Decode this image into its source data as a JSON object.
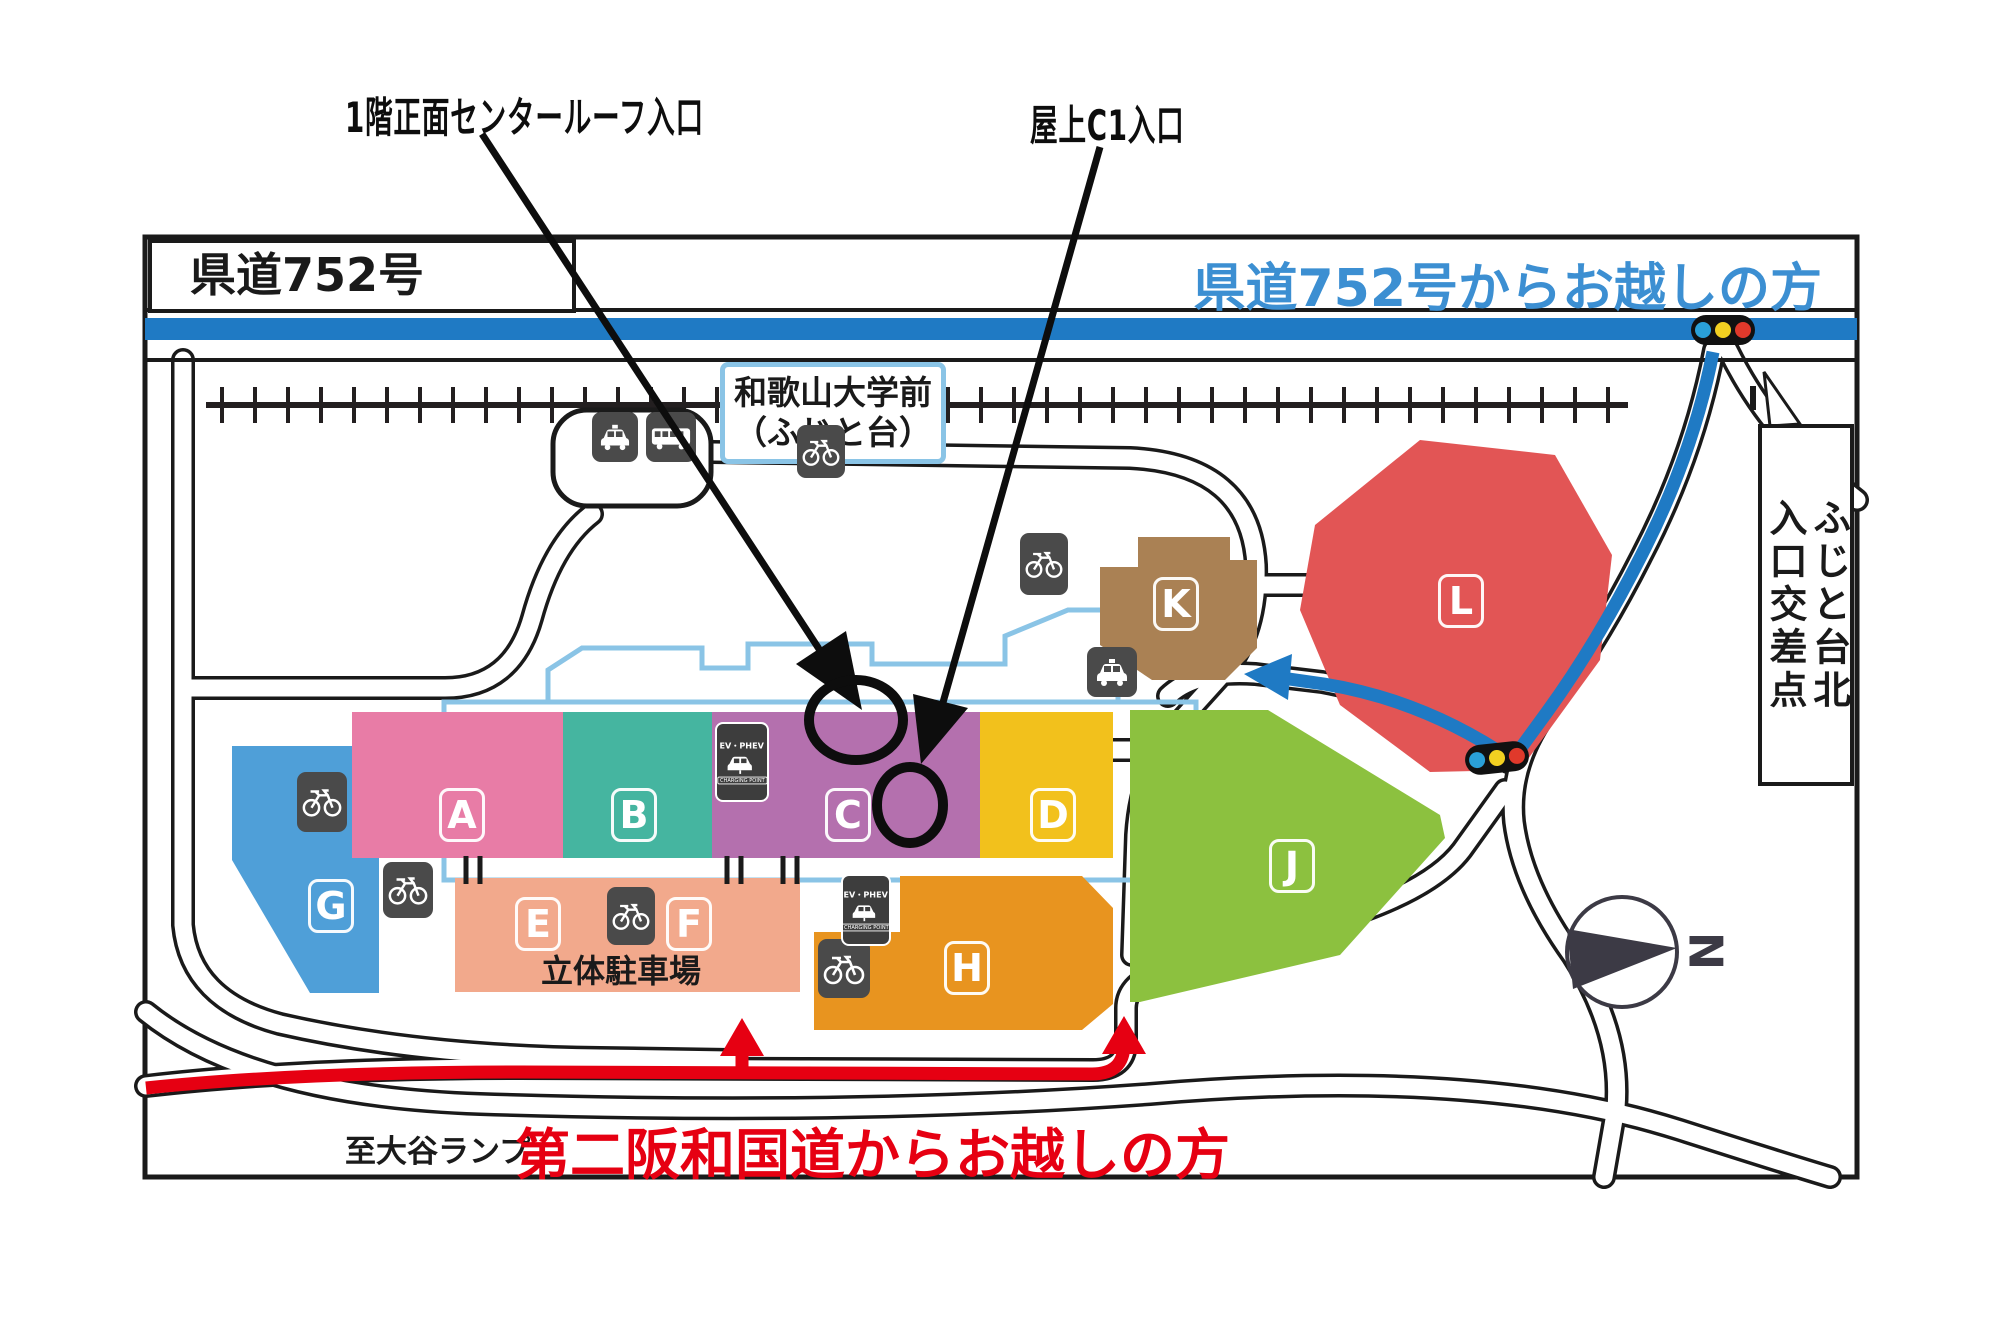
{
  "annotations": {
    "entrance1": "1階正面センタールーフ入口",
    "entrance2": "屋上C1入口"
  },
  "map": {
    "top_left_road": "県道752号",
    "blue_route_title": "県道752号からお越しの方",
    "red_route_title": "第二阪和国道からお越しの方",
    "ramp_label": "至大谷ランプ",
    "station": {
      "line1": "和歌山大学前",
      "line2": "（ふじと台）"
    },
    "callout": {
      "left_column": "入口交差点",
      "right_column": "ふじと台北"
    },
    "parking_label": "立体駐車場",
    "compass_label": "N"
  },
  "blocks": {
    "a": {
      "label": "A",
      "color": "#e87ca6"
    },
    "b": {
      "label": "B",
      "color": "#45b5a0"
    },
    "c": {
      "label": "C",
      "color": "#b470ae"
    },
    "d": {
      "label": "D",
      "color": "#f2c11c"
    },
    "ef": {
      "label_e": "E",
      "label_f": "F",
      "color": "#f2a98c"
    },
    "g": {
      "label": "G",
      "color": "#4f9fd8"
    },
    "h": {
      "label": "H",
      "color": "#e8941f"
    },
    "j": {
      "label": "J",
      "color": "#8cc13f"
    },
    "k": {
      "label": "K",
      "color": "#aa8154"
    },
    "l": {
      "label": "L",
      "color": "#e25555"
    }
  },
  "icons": {
    "ev_charging": {
      "title": "EV・PHEV",
      "subtitle": "CHARGING POINT"
    }
  },
  "colors": {
    "route_blue": "#1f7ac4",
    "route_red": "#e60012",
    "blue_text": "#3c8fd2",
    "outline": "#8ac4e6",
    "signal_blue": "#2aa0d8",
    "signal_yellow": "#f2d021",
    "signal_red": "#e0392b",
    "compass": "#3c3a45"
  }
}
